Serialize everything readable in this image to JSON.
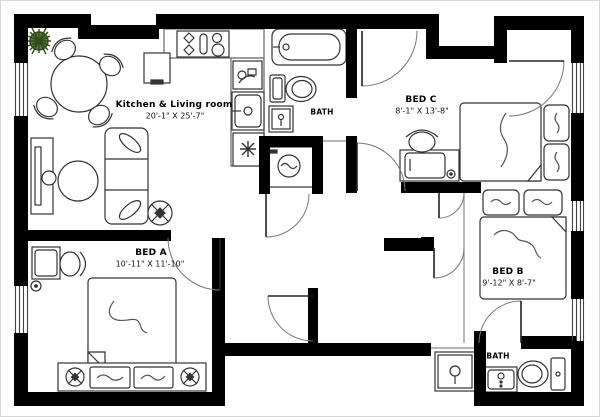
{
  "title": "Apartment floor plan",
  "colors": {
    "walls": "#000000",
    "furniture_line": "#333333",
    "door_arc": "#777777",
    "plant_green": "#4e6b30",
    "background": "#ffffff"
  },
  "rooms": [
    {
      "id": "kitchen_living",
      "name": "Kitchen & Living room",
      "dims": "20'-1\" X 25'-7\""
    },
    {
      "id": "bed_a",
      "name": "BED A",
      "dims": "10'-11\" X 11'-10\""
    },
    {
      "id": "bed_b",
      "name": "BED B",
      "dims": "9'-12\" X 8'-7\""
    },
    {
      "id": "bed_c",
      "name": "BED C",
      "dims": "8'-1\" X 13'-8\""
    },
    {
      "id": "bath_top",
      "name": "BATH",
      "dims": ""
    },
    {
      "id": "bath_bottom",
      "name": "BATH",
      "dims": ""
    }
  ]
}
